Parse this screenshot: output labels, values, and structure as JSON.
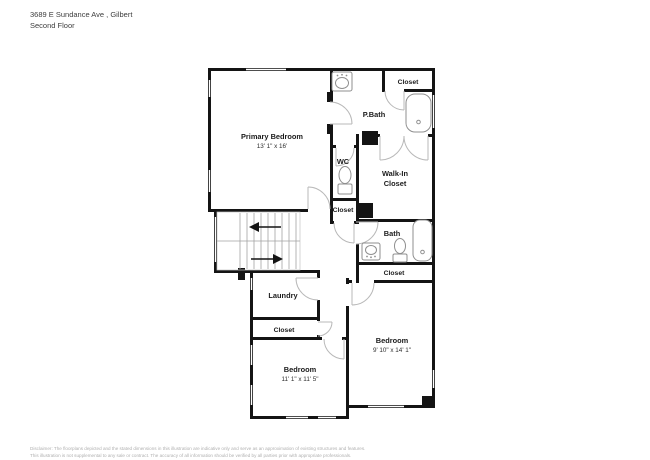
{
  "header": {
    "address": "3689 E Sundance Ave , Gilbert",
    "floor": "Second Floor"
  },
  "rooms": [
    {
      "id": "primary-bedroom",
      "name": "Primary Bedroom",
      "dims": "13' 1\" x 16'"
    },
    {
      "id": "p-bath",
      "name": "P.Bath"
    },
    {
      "id": "closet-top-right",
      "name": "Closet"
    },
    {
      "id": "wc",
      "name": "WC"
    },
    {
      "id": "walk-in-closet",
      "name": "Walk-In Closet",
      "line1": "Walk-In",
      "line2": "Closet"
    },
    {
      "id": "closet-hall",
      "name": "Closet"
    },
    {
      "id": "bath",
      "name": "Bath"
    },
    {
      "id": "closet-linen",
      "name": "Closet"
    },
    {
      "id": "laundry",
      "name": "Laundry"
    },
    {
      "id": "closet-bedroom",
      "name": "Closet"
    },
    {
      "id": "bedroom-left",
      "name": "Bedroom",
      "dims": "11' 1\" x 11' 5\""
    },
    {
      "id": "bedroom-right",
      "name": "Bedroom",
      "dims": "9' 10\" x 14' 1\""
    }
  ],
  "colors": {
    "wall": "#141414",
    "label": "#1b1b1b",
    "door_swing": "#b8b8b8",
    "fixture": "#8f8f8f",
    "stairs": "#a3a3a3",
    "background": "#ffffff"
  },
  "footer": {
    "line1": "Disclaimer: The floorplans depicted and the stated dimensions in this illustration are indicative only and serve as an approximation of existing structures and features.",
    "line2": "This illustration is not supplemental to any sale or contract. The accuracy of all information should be verified by all parties prior with appropriate professionals."
  }
}
